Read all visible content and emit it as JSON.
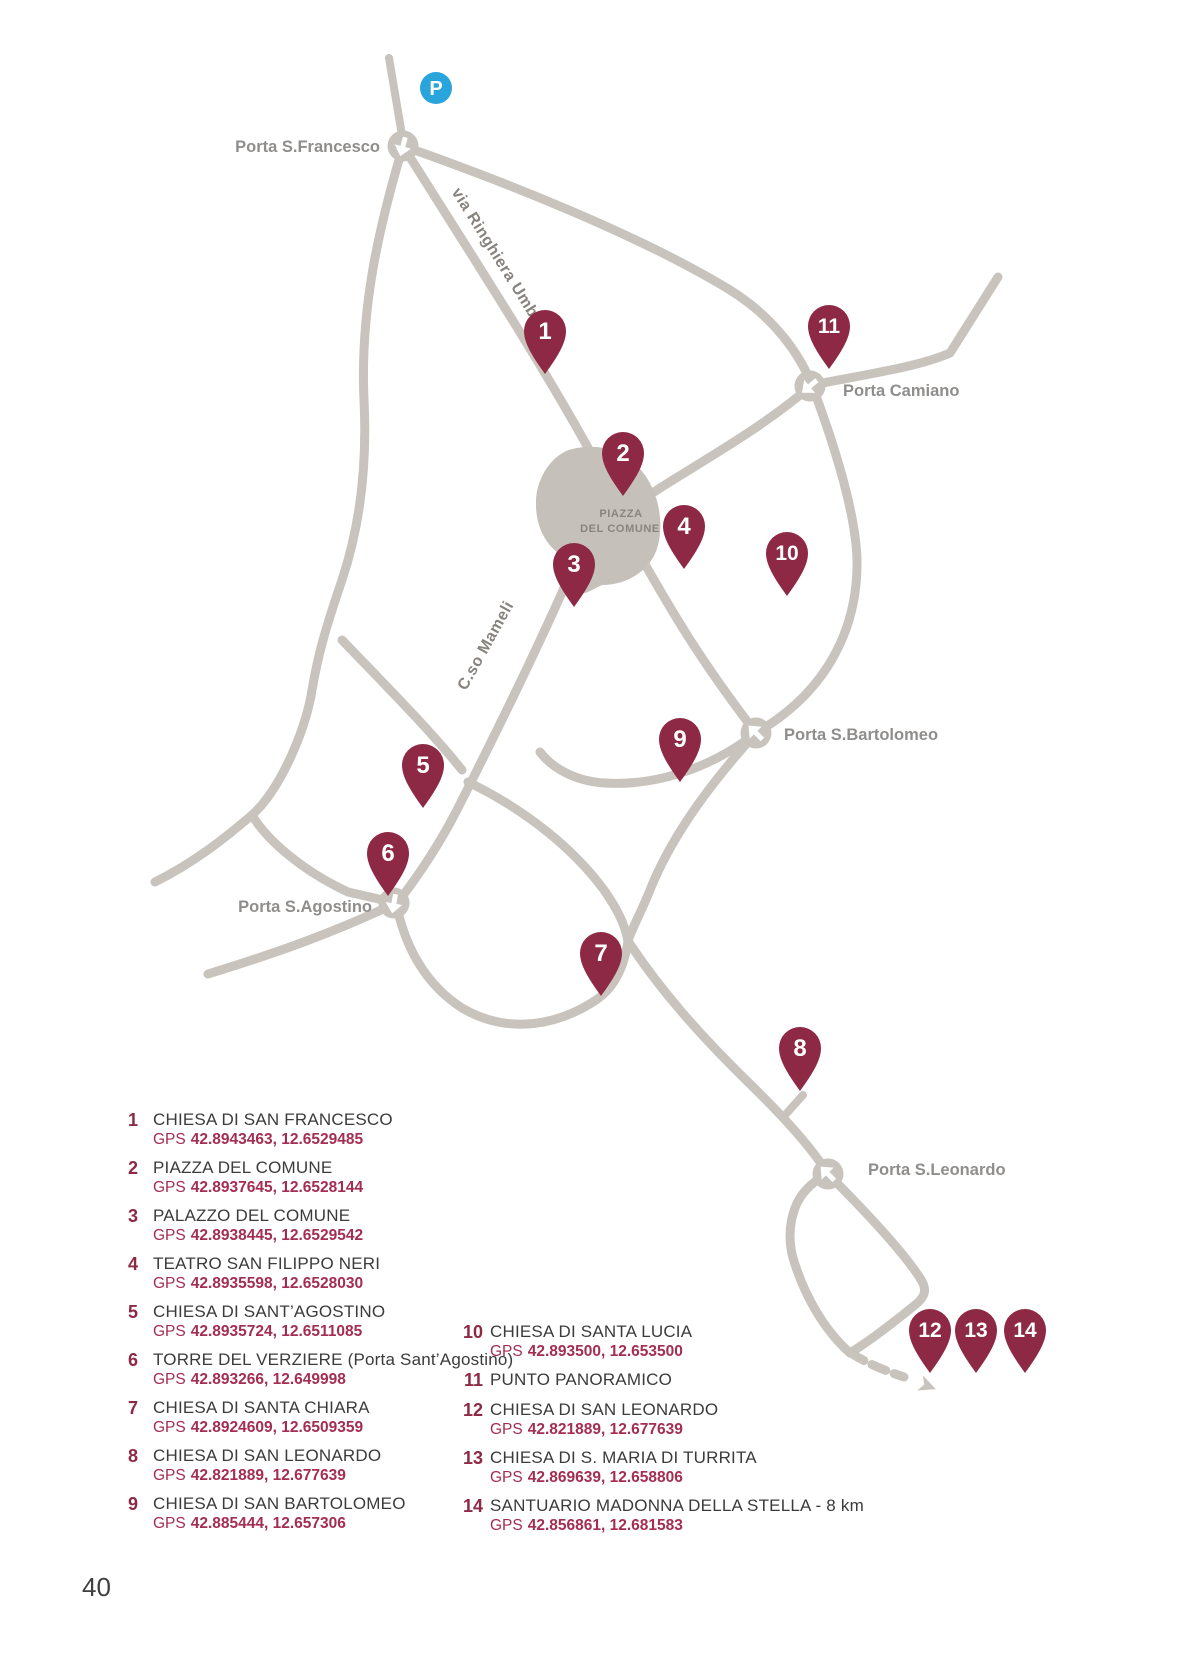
{
  "page": {
    "number": "40"
  },
  "map": {
    "parking": {
      "label": "P"
    },
    "piazza": {
      "line1": "PIAZZA",
      "line2": "DEL COMUNE"
    },
    "streets": {
      "ringhiera": "via Ringhiera Umbra",
      "mameli": "C.so Mameli"
    },
    "gates": {
      "francesco": "Porta S.Francesco",
      "camiano": "Porta Camiano",
      "bartolomeo": "Porta S.Bartolomeo",
      "agostino": "Porta S.Agostino",
      "leonardo": "Porta S.Leonardo"
    },
    "pin_labels": [
      "1",
      "2",
      "3",
      "4",
      "5",
      "6",
      "7",
      "8",
      "9",
      "10",
      "11",
      "12",
      "13",
      "14"
    ]
  },
  "legend": {
    "gps_label": "GPS",
    "column1": [
      {
        "number": "1",
        "title": "CHIESA DI SAN FRANCESCO",
        "gps": "42.8943463, 12.6529485"
      },
      {
        "number": "2",
        "title": "PIAZZA DEL COMUNE",
        "gps": "42.8937645, 12.6528144"
      },
      {
        "number": "3",
        "title": "PALAZZO DEL COMUNE",
        "gps": "42.8938445, 12.6529542"
      },
      {
        "number": "4",
        "title": "TEATRO SAN FILIPPO NERI",
        "gps": "42.8935598, 12.6528030"
      },
      {
        "number": "5",
        "title": "CHIESA DI SANT’AGOSTINO",
        "gps": "42.8935724, 12.6511085"
      },
      {
        "number": "6",
        "title": "TORRE DEL VERZIERE (Porta Sant’Agostino)",
        "gps": "42.893266, 12.649998"
      },
      {
        "number": "7",
        "title": "CHIESA DI SANTA CHIARA",
        "gps": "42.8924609, 12.6509359"
      },
      {
        "number": "8",
        "title": "CHIESA DI SAN LEONARDO",
        "gps": "42.821889, 12.677639"
      },
      {
        "number": "9",
        "title": "CHIESA DI SAN BARTOLOMEO",
        "gps": "42.885444, 12.657306"
      }
    ],
    "column2": [
      {
        "number": "10",
        "title": "CHIESA DI SANTA LUCIA",
        "gps": "42.893500, 12.653500"
      },
      {
        "number": "11",
        "title": "PUNTO PANORAMICO",
        "gps": ""
      },
      {
        "number": "12",
        "title": "CHIESA DI SAN LEONARDO",
        "gps": "42.821889, 12.677639"
      },
      {
        "number": "13",
        "title": "CHIESA DI S. MARIA DI TURRITA",
        "gps": "42.869639, 12.658806"
      },
      {
        "number": "14",
        "title": "SANTUARIO MADONNA DELLA STELLA - 8 km",
        "gps": "42.856861, 12.681583"
      }
    ]
  },
  "colors": {
    "pin": "#8d2944",
    "road": "#c9c3bd",
    "parking_blue": "#2aa4dc",
    "gps_text": "#a42d52",
    "title_text": "#3b3b3b",
    "gray_label": "#908e8c"
  }
}
